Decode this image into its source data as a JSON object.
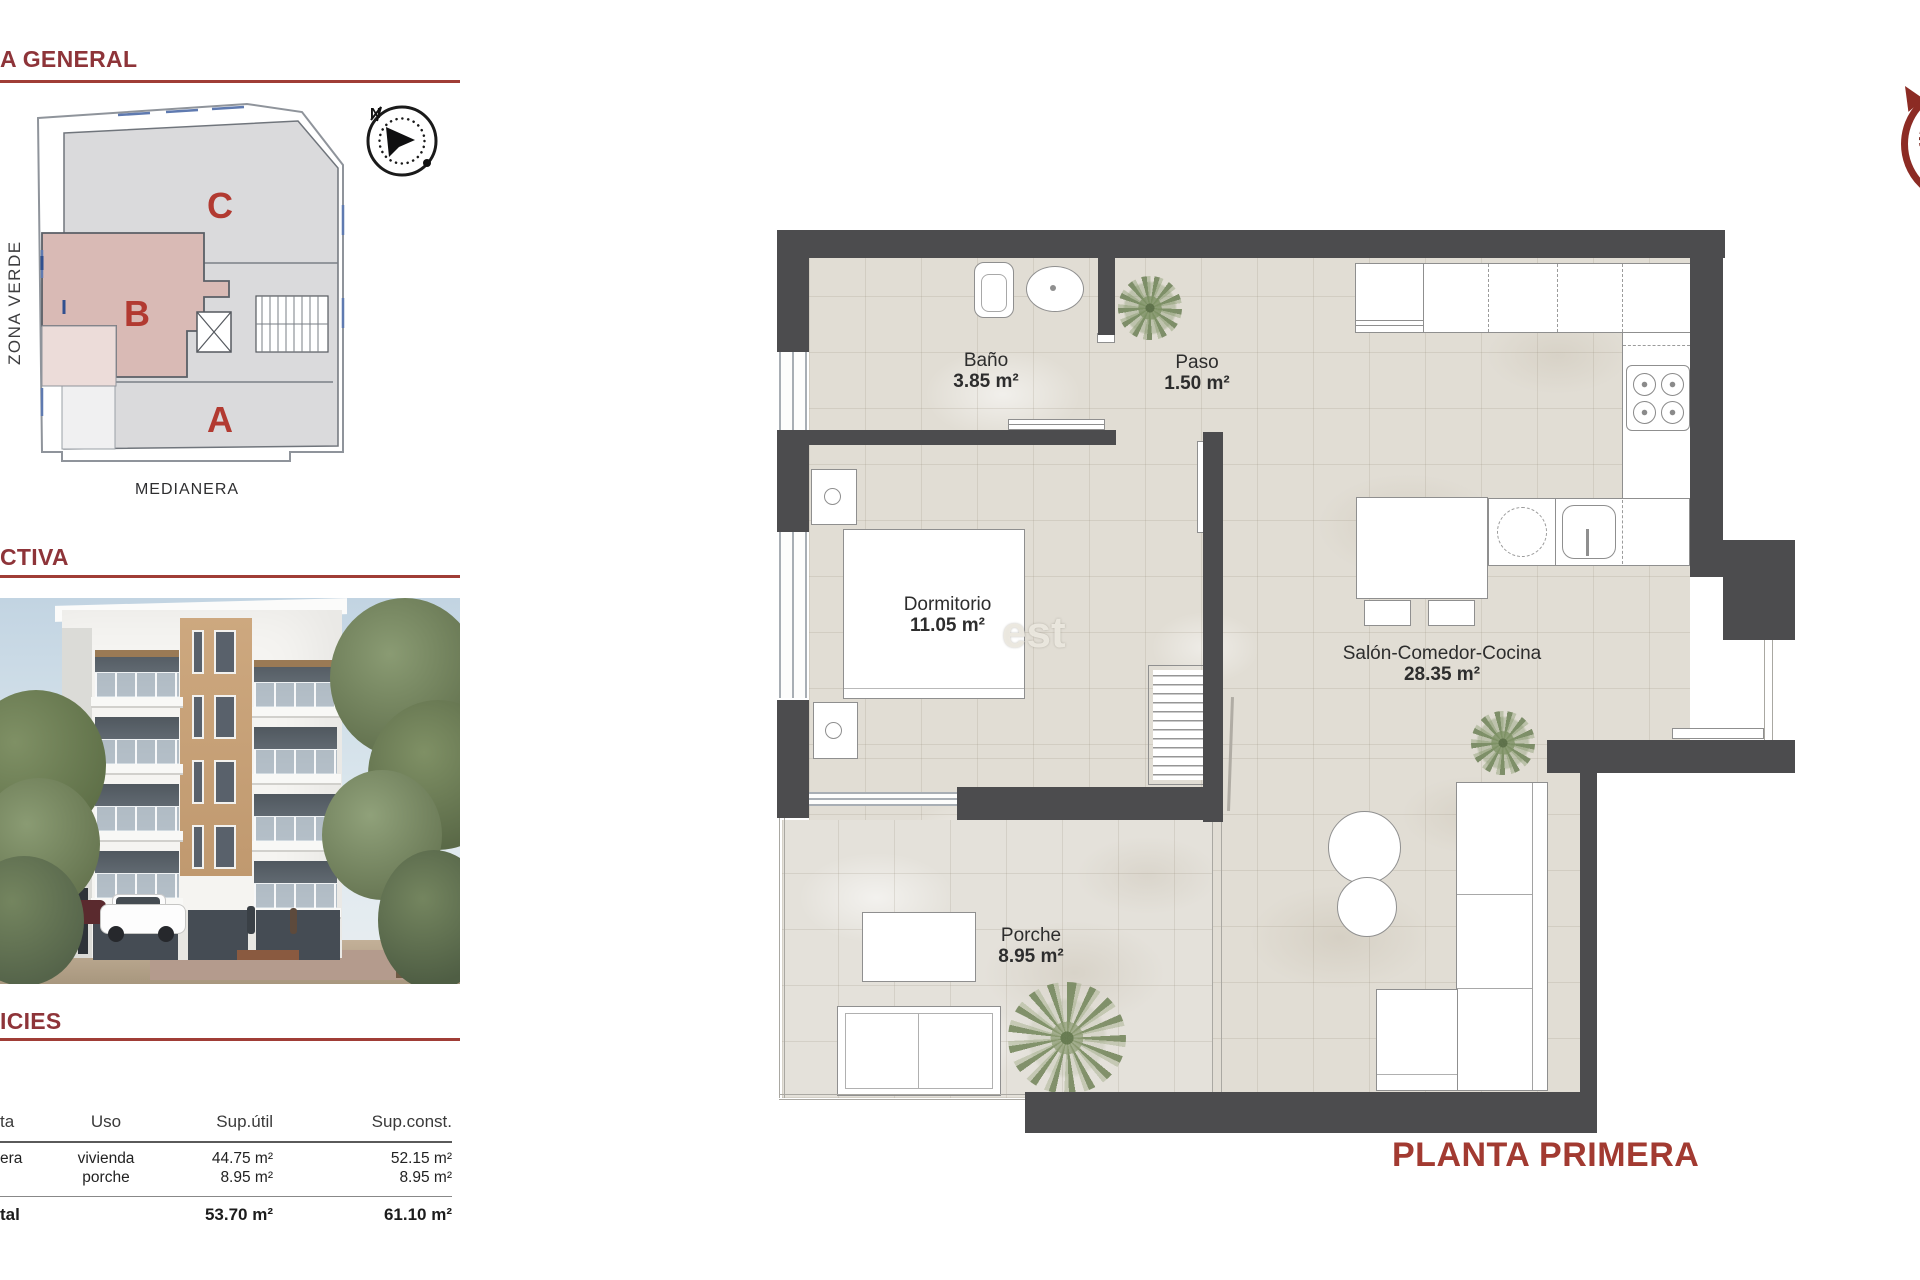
{
  "colors": {
    "accent_red": "#8e3439",
    "rule_red": "#a03d36",
    "letter_red": "#b23a31",
    "title_red": "#a23a31",
    "wall_gray": "#4c4c4e",
    "floor_beige": "#e1ddd4",
    "highlight_pink": "#d9bab5"
  },
  "left_panel": {
    "section_general": {
      "title": "A GENERAL"
    },
    "site_plan": {
      "block_c": "C",
      "block_b": "B",
      "block_a": "A",
      "zona_verde": "ZONA VERDE",
      "medianera": "MEDIANERA",
      "compass_n": "N"
    },
    "section_perspective": {
      "title": "CTIVA"
    },
    "section_superficies": {
      "title": "ICIES"
    },
    "table": {
      "headers": {
        "planta": "ta",
        "uso": "Uso",
        "sup_util": "Sup.útil",
        "sup_const": "Sup.const."
      },
      "rows": [
        {
          "planta": "era",
          "uso": "vivienda",
          "sup_util": "44.75 m²",
          "sup_const": "52.15 m²"
        },
        {
          "planta": "",
          "uso": "porche",
          "sup_util": "8.95 m²",
          "sup_const": "8.95 m²"
        }
      ],
      "total": {
        "planta": "tal",
        "uso": "",
        "sup_util": "53.70 m²",
        "sup_const": "61.10 m²"
      }
    }
  },
  "floor_plan": {
    "title": "PLANTA PRIMERA",
    "watermark": "est",
    "rooms": {
      "bano": {
        "name": "Baño",
        "area": "3.85 m²"
      },
      "paso": {
        "name": "Paso",
        "area": "1.50 m²"
      },
      "dormitorio": {
        "name": "Dormitorio",
        "area": "11.05 m²"
      },
      "salon": {
        "name": "Salón-Comedor-Cocina",
        "area": "28.35 m²"
      },
      "porche": {
        "name": "Porche",
        "area": "8.95 m²"
      }
    }
  }
}
